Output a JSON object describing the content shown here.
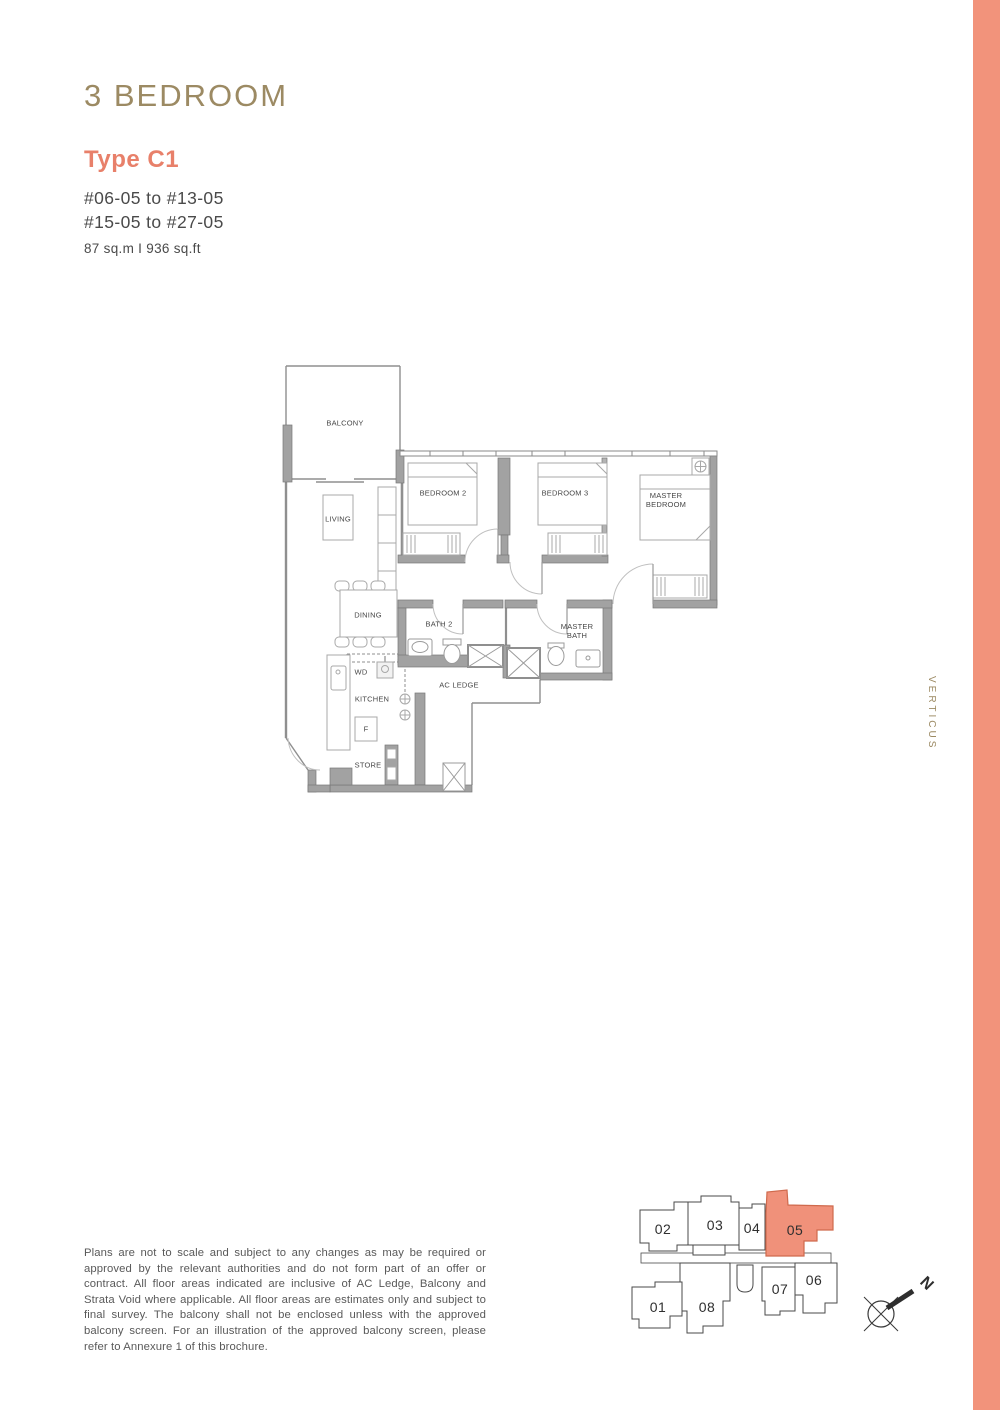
{
  "header": {
    "title": "3 BEDROOM",
    "type": "Type C1",
    "range1": "#06-05 to #13-05",
    "range2": "#15-05 to #27-05",
    "area": "87 sq.m I 936 sq.ft"
  },
  "floor_plan": {
    "rooms": {
      "balcony": "BALCONY",
      "living": "LIVING",
      "bedroom2": "BEDROOM 2",
      "bedroom3": "BEDROOM 3",
      "master_bedroom": "MASTER BEDROOM",
      "dining": "DINING",
      "bath2": "BATH 2",
      "master_bath": "MASTER BATH",
      "wd": "WD",
      "kitchen": "KITCHEN",
      "fridge": "F",
      "ac_ledge": "AC LEDGE",
      "store": "STORE"
    }
  },
  "site_key": {
    "units": [
      {
        "number": "01",
        "highlighted": false
      },
      {
        "number": "02",
        "highlighted": false
      },
      {
        "number": "03",
        "highlighted": false
      },
      {
        "number": "04",
        "highlighted": false
      },
      {
        "number": "05",
        "highlighted": true
      },
      {
        "number": "06",
        "highlighted": false
      },
      {
        "number": "07",
        "highlighted": false
      },
      {
        "number": "08",
        "highlighted": false
      }
    ],
    "highlighted_unit": "05",
    "north_label": "N"
  },
  "brand": {
    "vertical_text": "VERTICUS"
  },
  "footer": {
    "disclaimer": "Plans are not to scale and subject to any changes as may be required or approved by the relevant authorities and do not form part of an offer or contract. All floor areas indicated are inclusive of AC Ledge, Balcony and Strata Void where applicable. All floor areas are estimates only and subject to final survey. The balcony shall not be enclosed unless with the approved balcony screen. For an illustration of the approved balcony screen, please refer to Annexure 1 of this brochure."
  },
  "colors": {
    "accent_gold": "#9c8a63",
    "accent_coral": "#e8806a",
    "right_strip": "#f2937b",
    "site_highlight": "#f0917a",
    "wall_gray": "#a2a2a2"
  }
}
